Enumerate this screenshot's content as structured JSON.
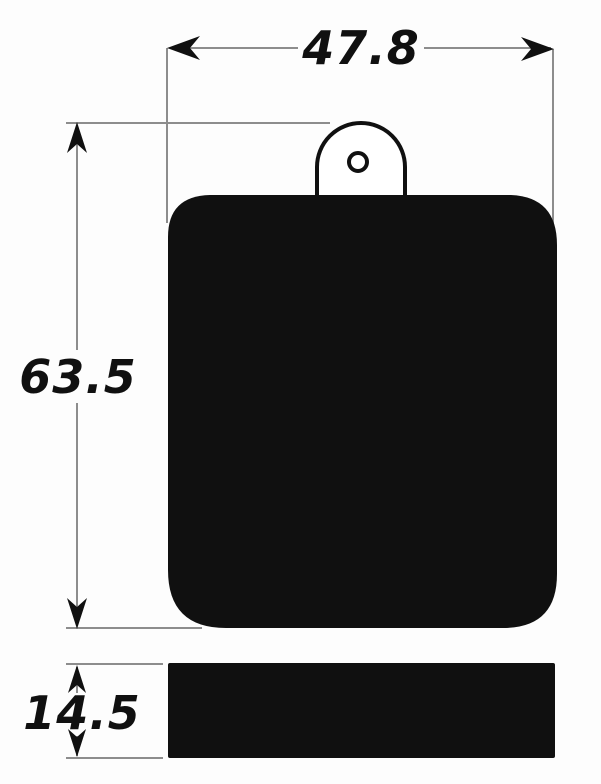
{
  "dimensions": {
    "width": "47.8",
    "height": "63.5",
    "thickness": "14.5"
  },
  "colors": {
    "ink": "#101010",
    "dim_line": "#8d8d8d",
    "background": "#fdfdfd"
  }
}
